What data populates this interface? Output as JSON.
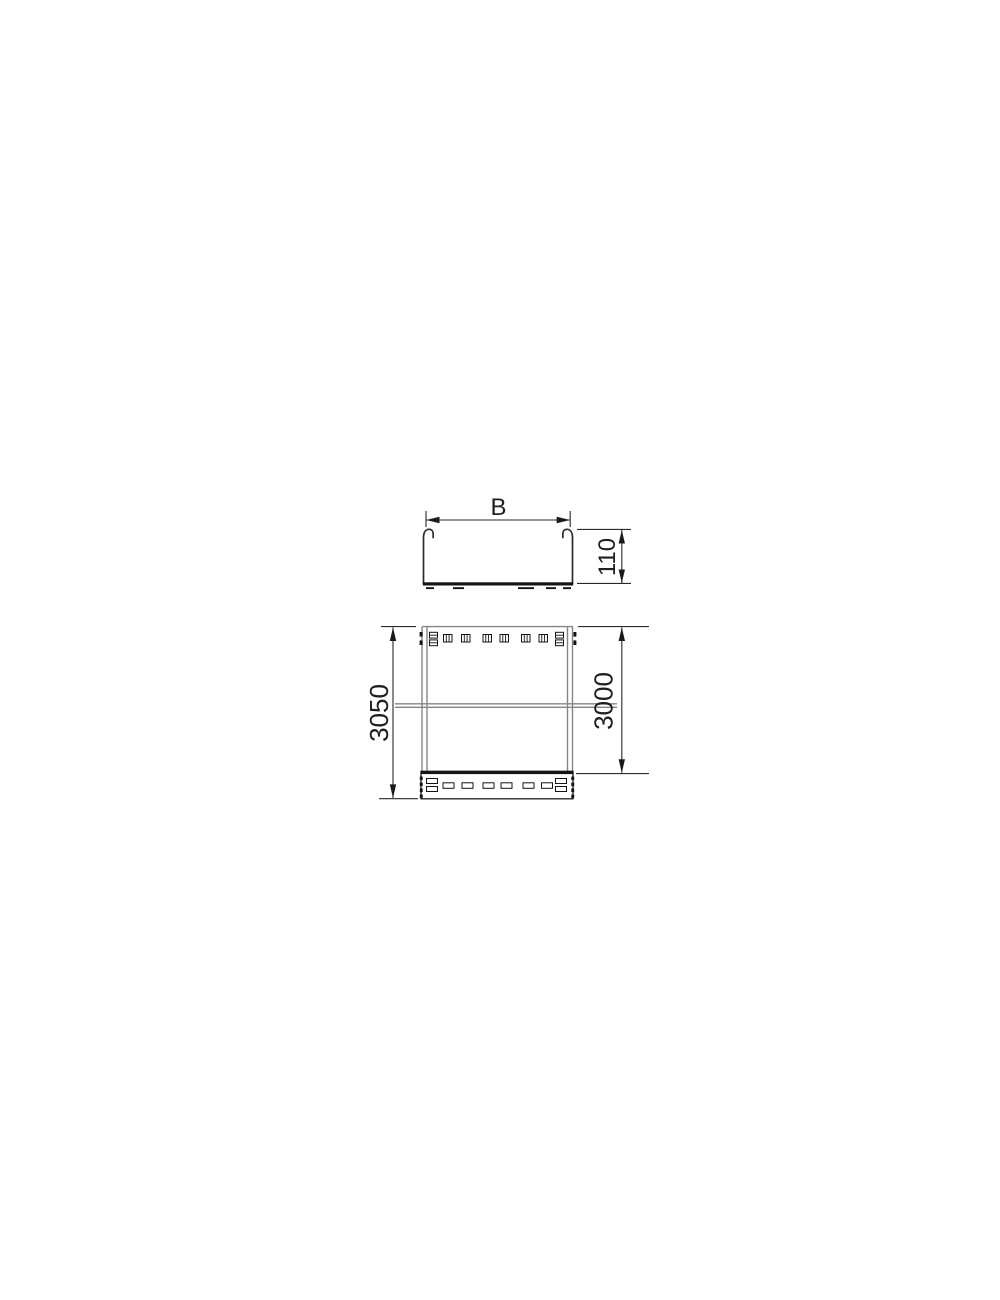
{
  "drawing": {
    "type": "technical-dimension-drawing",
    "subject": "cable-tray",
    "cross_section_view": {
      "width_dimension_label": "B",
      "height_dimension_label": "110"
    },
    "plan_view": {
      "total_length_dimension_label": "3050",
      "body_length_dimension_label": "3000"
    },
    "colors": {
      "background": "#ffffff",
      "main_line": "#2a2a2a",
      "thin_line": "#858585",
      "text": "#1f1f1f"
    }
  }
}
